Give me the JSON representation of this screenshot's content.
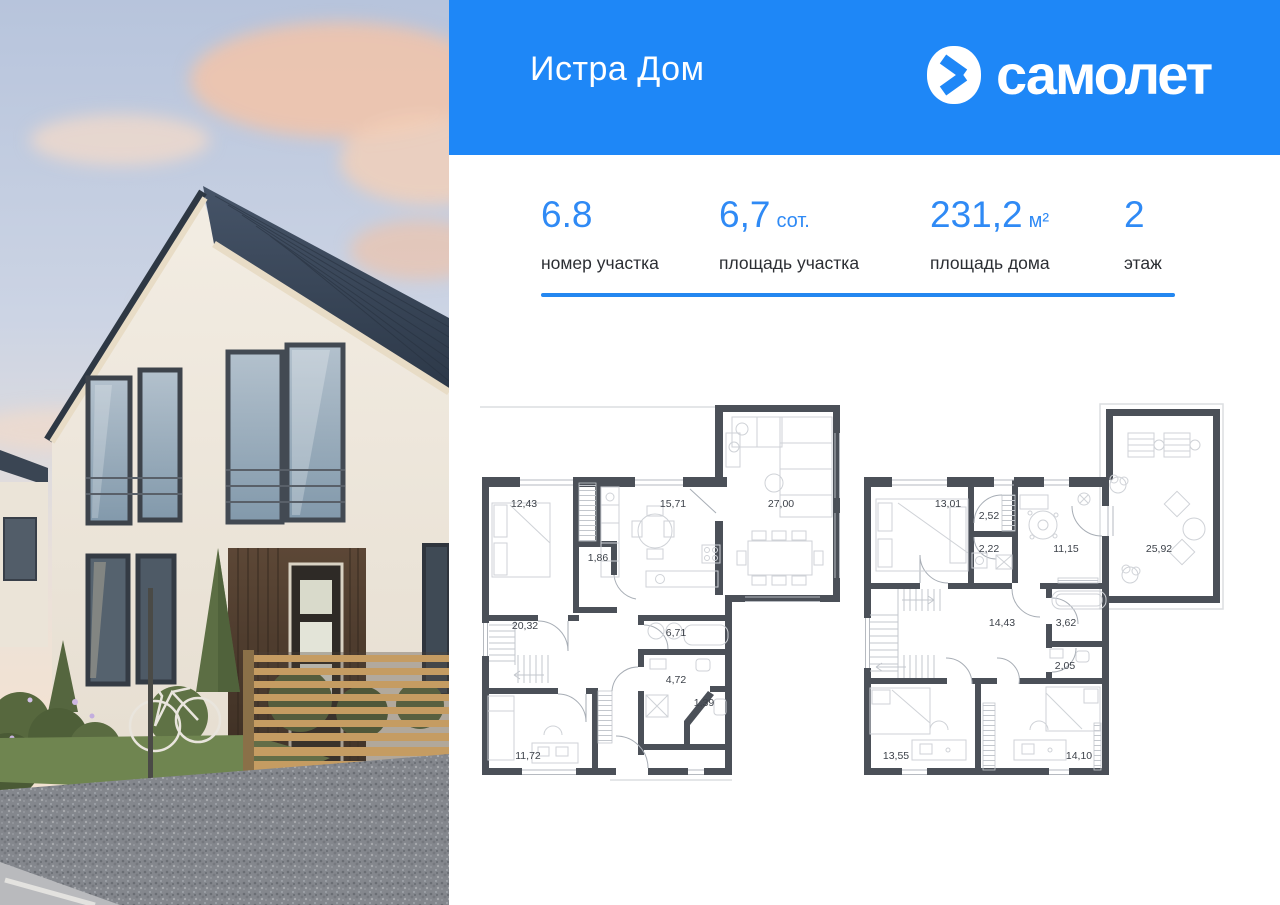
{
  "header": {
    "title": "Истра Дом",
    "brand_wordmark": "самолет"
  },
  "stats": {
    "items": [
      {
        "value": "6.8",
        "unit": "",
        "label": "номер участка"
      },
      {
        "value": "6,7",
        "unit": "сот.",
        "label": "площадь участка"
      },
      {
        "value": "231,2",
        "unit": "м²",
        "label": "площадь  дома"
      },
      {
        "value": "2",
        "unit": "",
        "label": "этаж"
      }
    ]
  },
  "colors": {
    "header_bg": "#1e87f7",
    "accent": "#2f8af5",
    "divider": "#2487f0",
    "plan_walls": "#4b5058"
  },
  "floor_plans": {
    "floor_1": {
      "rooms": [
        {
          "area": "12,43"
        },
        {
          "area": "15,71"
        },
        {
          "area": "27,00"
        },
        {
          "area": "1,86"
        },
        {
          "area": "20,32"
        },
        {
          "area": "6,71"
        },
        {
          "area": "4,72"
        },
        {
          "area": "1,39"
        },
        {
          "area": "11,72"
        }
      ]
    },
    "floor_2": {
      "rooms": [
        {
          "area": "13,01"
        },
        {
          "area": "2,52"
        },
        {
          "area": "2,22"
        },
        {
          "area": "11,15"
        },
        {
          "area": "25,92"
        },
        {
          "area": "14,43"
        },
        {
          "area": "3,62"
        },
        {
          "area": "2,05"
        },
        {
          "area": "13,55"
        },
        {
          "area": "14,10"
        }
      ]
    }
  }
}
